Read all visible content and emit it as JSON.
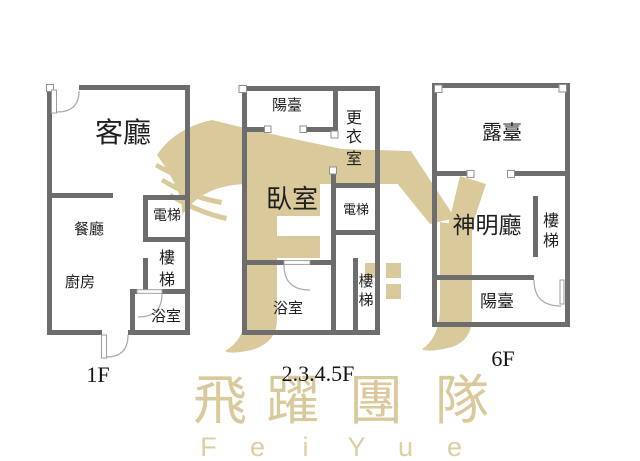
{
  "colors": {
    "wall": "#6d6d6d",
    "label": "#1f1f1f",
    "floor_label": "#141414",
    "watermark": "#d9c99b",
    "watermark_latin": "#dccfa3"
  },
  "plans": [
    {
      "floor_label": "1F",
      "rooms": {
        "living": {
          "label": "客廳"
        },
        "dining": {
          "label": "餐廳"
        },
        "kitchen": {
          "label": "廚房"
        },
        "elevator": {
          "label": "電梯"
        },
        "stairs": {
          "label": "樓梯",
          "chars": [
            "樓",
            "梯"
          ]
        },
        "bath": {
          "label": "浴室"
        }
      }
    },
    {
      "floor_label": "2.3.4.5F",
      "rooms": {
        "balcony": {
          "label": "陽臺"
        },
        "closet": {
          "label": "更衣室",
          "chars": [
            "更",
            "衣",
            "室"
          ]
        },
        "bedroom": {
          "label": "臥室"
        },
        "elevator": {
          "label": "電梯"
        },
        "bath": {
          "label": "浴室"
        },
        "stairs": {
          "label": "樓梯",
          "chars": [
            "樓",
            "梯"
          ]
        }
      }
    },
    {
      "floor_label": "6F",
      "rooms": {
        "terrace": {
          "label": "露臺"
        },
        "shrine": {
          "label": "神明廳"
        },
        "stairs": {
          "label": "樓梯",
          "chars": [
            "樓",
            "梯"
          ]
        },
        "balcony": {
          "label": "陽臺"
        }
      }
    }
  ],
  "watermark": {
    "brand_cjk": "飛躍團隊",
    "cjk_chars": [
      "飛",
      "躍",
      "團",
      "隊"
    ],
    "brand_latin": "FeiYue",
    "latin_chars": [
      "F",
      "e",
      "i",
      "Y",
      "u",
      "e"
    ]
  }
}
